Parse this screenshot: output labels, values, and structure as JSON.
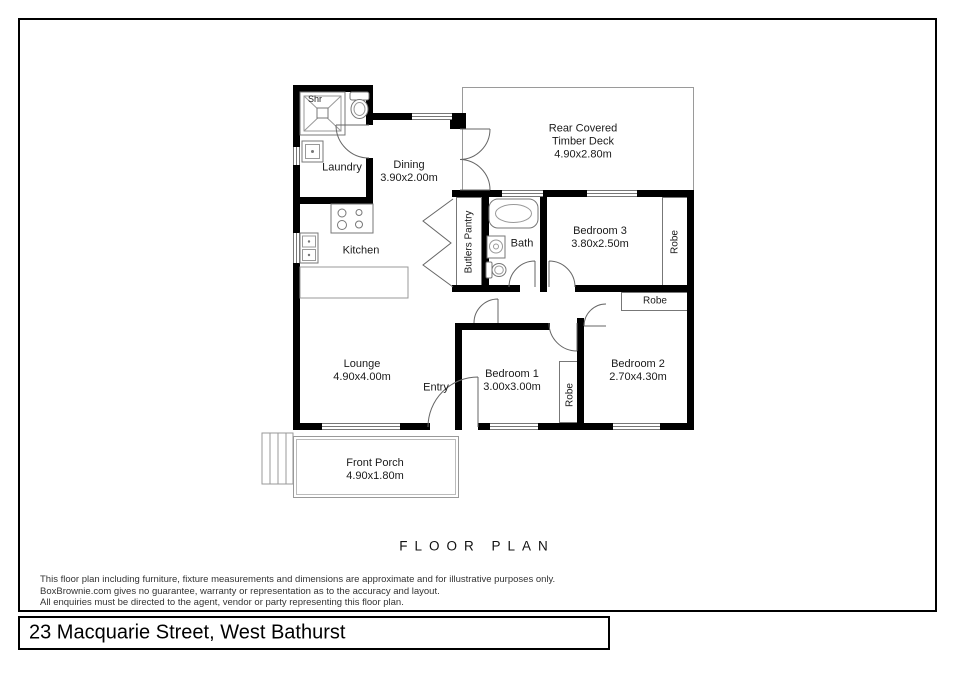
{
  "plan": {
    "title": "FLOOR PLAN",
    "rooms": {
      "shower": {
        "label": "Shr"
      },
      "laundry": {
        "label": "Laundry"
      },
      "dining": {
        "label": "Dining",
        "dims": "3.90x2.00m"
      },
      "deck": {
        "line1": "Rear Covered",
        "line2": "Timber Deck",
        "dims": "4.90x2.80m"
      },
      "kitchen": {
        "label": "Kitchen"
      },
      "butlers_pantry": {
        "label": "Butlers Pantry"
      },
      "bath": {
        "label": "Bath"
      },
      "bedroom3": {
        "label": "Bedroom 3",
        "dims": "3.80x2.50m"
      },
      "robe_bed3": {
        "label": "Robe"
      },
      "robe_bed2": {
        "label": "Robe"
      },
      "robe_bed1": {
        "label": "Robe"
      },
      "lounge": {
        "label": "Lounge",
        "dims": "4.90x4.00m"
      },
      "entry": {
        "label": "Entry"
      },
      "bedroom1": {
        "label": "Bedroom 1",
        "dims": "3.00x3.00m"
      },
      "bedroom2": {
        "label": "Bedroom 2",
        "dims": "2.70x4.30m"
      },
      "porch": {
        "label": "Front Porch",
        "dims": "4.90x1.80m"
      }
    }
  },
  "footer": {
    "disclaimer_line1": "This floor plan including furniture, fixture measurements and dimensions are approximate and for illustrative purposes only.",
    "disclaimer_line2": "BoxBrownie.com gives no guarantee, warranty or representation as to the accuracy and layout.",
    "disclaimer_line3": "All enquiries must be directed to the agent, vendor or party representing this floor plan.",
    "address": "23 Macquarie Street, West Bathurst"
  },
  "colors": {
    "wall": "#000000",
    "thin_line": "#777777",
    "text": "#1a1a1a"
  }
}
